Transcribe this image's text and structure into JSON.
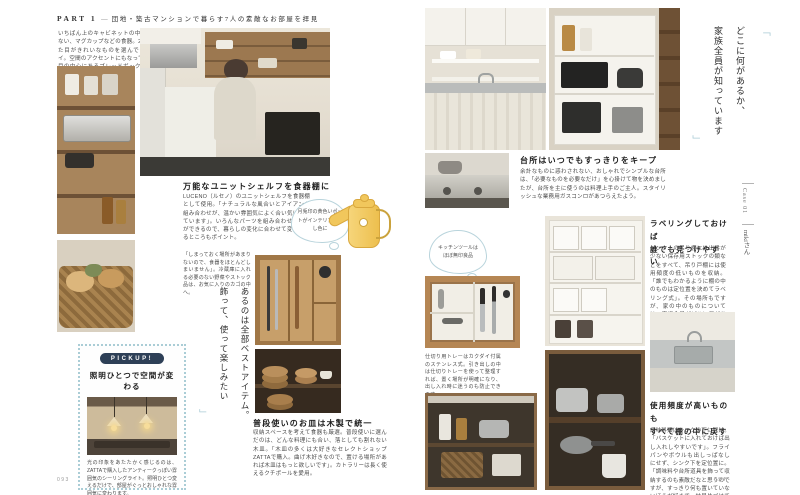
{
  "colors": {
    "accent_blue": "#a9cbd5",
    "navy_pill": "#2e4057",
    "page_background": "#ffffff",
    "heading_text": "#1c1c1c",
    "body_text": "#4a4a4a",
    "kettle_yellow": "#f1c75c"
  },
  "header": {
    "part_label": "PART 1",
    "separator": "—",
    "title": "団地・築古マンションで暮らす7人の素敵なお部屋を拝見"
  },
  "edge_tab": {
    "case_label": "Case 01",
    "resident_name": "mikiさん"
  },
  "page_numbers": {
    "left": "093",
    "right": "094"
  },
  "left_page": {
    "intro_caption": "いちばん上のキャビネットの中は普段使わない、マグカップなどの食器。2段目は、見た目がきれいなものを選んでディスプレイ。空間のアクセントにもなっている、3段目の中心にあるブレッドボックスは、子どもたちもお気に入り。",
    "quote": {
      "open": "「",
      "line1": "あるのは全部ベストアイテム。",
      "line2": "飾って、使って楽しみたい",
      "close": "」"
    },
    "section_unit_shelf": {
      "heading": "万能なユニットシェルフを食器棚に",
      "body": "LUCENO（ルセノ）のユニットシェルフを食器棚として使用。「ナチュラルな風合いとアイアンの組み合わせが、温かい雰囲気によく合い気に入っています」。いろんなパーツを組み合わせることができるので、暮らしの変化に合わせて変えられるところもポイント。"
    },
    "kettle_bubble": "月兎印の黄色いポットがインテリアの差し色に",
    "basket_caption": "「しまっておく場所があまりないので、食器をほとんどしまいません」。冷蔵庫に入れる必要のない野菜やストック品は、お気に入りのカゴの中へ。",
    "pickup": {
      "label": "PICKUP!",
      "heading": "照明ひとつで空間が変わる",
      "body": "光の印象をあたたかく感じるのは、ZATTAで購入したアンティークっぽい雰囲気のシーリングライト。照明ひとつ変えるだけで、部屋がぐっとおしゃれな雰囲気に変わります。"
    },
    "section_wood_plates": {
      "heading": "普段使いのお皿は木製で統一",
      "body": "収納スペースを考えて食器も厳選。普段使いに選んだのは、どんな料理にも合い、落としても割れない木皿。「木皿の多くは大好きなセレクトショップZATTAで購入。曲げ木好きなので、置ける場所があれば木皿はもっと欲しいです」。カトラリーは長く使えるクチポールを愛用。"
    }
  },
  "right_page": {
    "quote": {
      "open": "「",
      "line1": "どこに何があるか、",
      "line2": "家族全員が知っています",
      "close": "」"
    },
    "section_tidy": {
      "heading": "台所はいつでもすっきりをキープ",
      "body": "余計なものに惑わされない、おしゃれでシンプルな台所は、「必要なものを必要なだけ」を心掛けて物を決めましたが、台所を主に使うのは料理上手のご主人。スタイリッシュな業務用ガスコンロがあつらえたよう。"
    },
    "tools_bubble": "キッチンツールは ほぼ無印良品",
    "section_labeling": {
      "heading_line1": "ラベリングしておけば",
      "heading_line2": "誰でも見つけやすい",
      "body": "シンク上の吊り棚には出番が少ない保存用ストックの類などをすべて、吊り戸棚には使用頻度の低いものを収納。「誰でもわかるように棚の中のものは定位置を決めてラベリング式」。その場所もですが、家の中のものについては、家族全員がどこに何があるかだいたいわかっています。"
    },
    "drawer_caption": "仕切り用トレーはカクダイ付属のステンレス式。引き出しの中は仕切りトレーを使って整理すれば、置く場所が明確になり、出し入れ時に迷うのも防止できます。",
    "section_restock": {
      "heading_line1": "使用頻度が高いものも",
      "heading_line2": "すべて棚の中に戻す",
      "body": "調味料類はシンクの下に収納。「バスケットに入れておけば出し入れしやすいです」。フライパンやボウルも出しっぱなしにせず、シンク下を定位置に。「調味料や台所道具を飾って収納するのも素敵だなと思うのですが、すっきり何も置いていないほうが好きで、結局片づけてしまいます」。"
    }
  }
}
